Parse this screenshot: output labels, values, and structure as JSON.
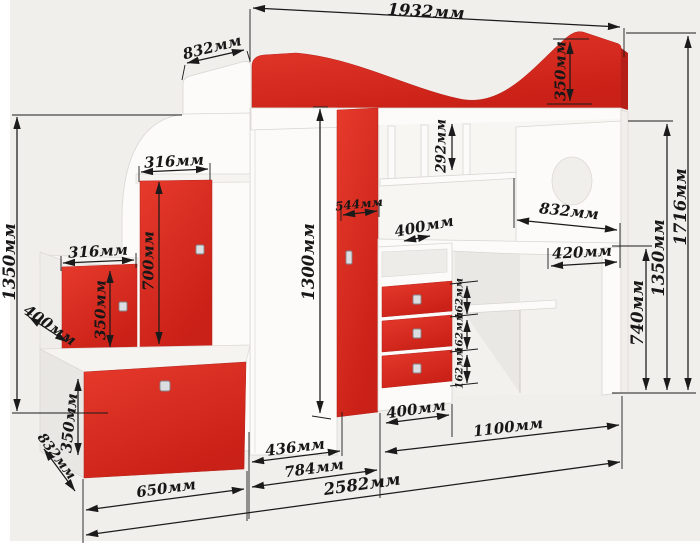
{
  "units": "мм",
  "colors": {
    "accent_red": "#d6291f",
    "dimension_line": "#1b1b1b",
    "background": "#f1efec",
    "furniture_white": "#fcfbf9"
  },
  "dimensions": {
    "bed_length_top": "1932мм",
    "bed_width": "832мм",
    "bed_panel_height": "350мм",
    "overall_height": "1716мм",
    "loft_clearance_height": "1350мм",
    "desk_height": "740мм",
    "desk_length": "832мм",
    "desk_corner_depth": "420мм",
    "shelf_opening_height": "292мм",
    "desk_return_depth": "400мм",
    "wardrobe_door_width": "544мм",
    "wardrobe_height": "1300мм",
    "upper_step_door_width": "316мм",
    "upper_step_door_height": "700мм",
    "lower_step_door_width": "316мм",
    "lower_step_door_height": "350мм",
    "step_depth": "400мм",
    "stairs_height": "1350мм",
    "bench_drawer_height": "350мм",
    "bench_depth": "832мм",
    "bench_width": "650мм",
    "cabinet_depth": "436мм",
    "wardrobe_section_width": "784мм",
    "overall_length": "2582мм",
    "drawer_unit_width": "400мм",
    "desk_section_width": "1100мм",
    "drawer_front_height_top": "162мм",
    "drawer_front_height_middle": "162мм",
    "drawer_front_height_bottom": "162мм"
  }
}
